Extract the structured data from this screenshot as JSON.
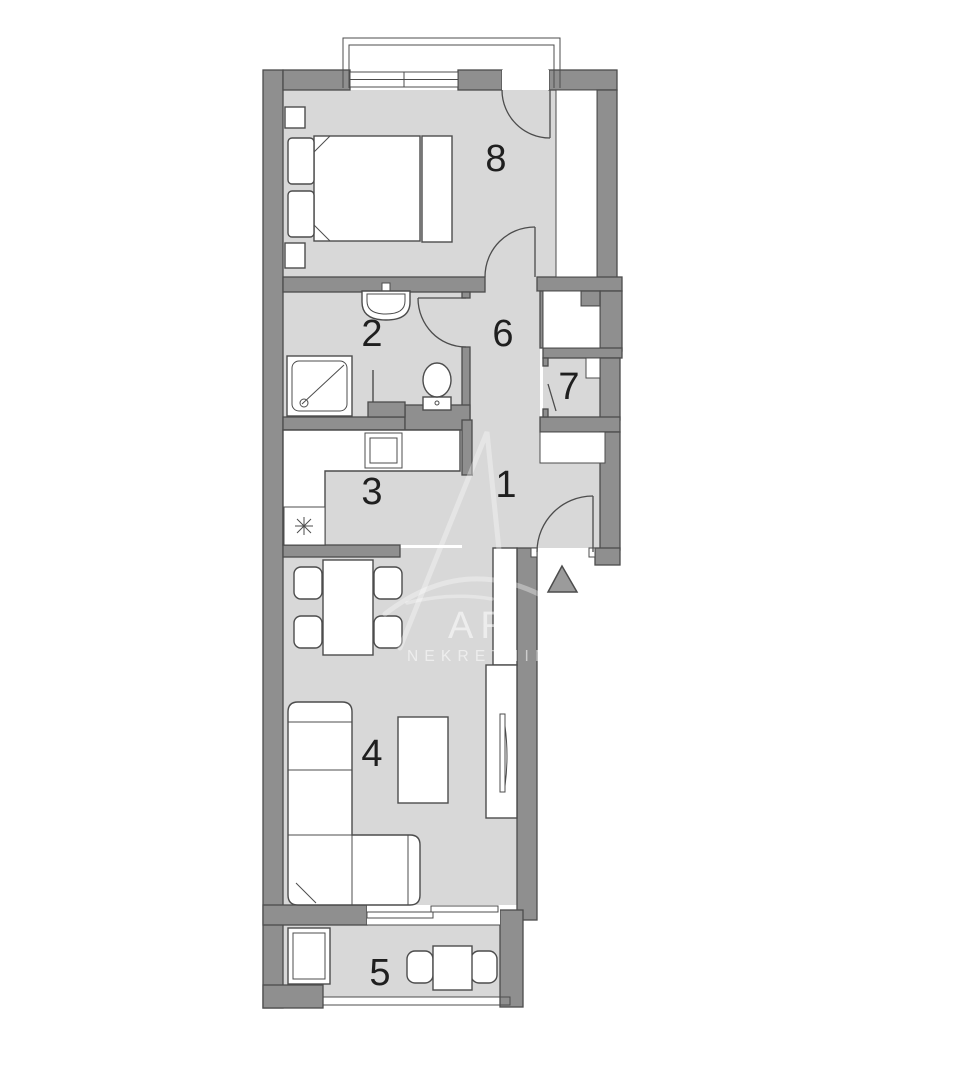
{
  "colors": {
    "wall": "#8f8f8f",
    "wall_outline": "#4c4c4c",
    "floor": "#d8d8d8",
    "furniture": "#ffffff",
    "furniture_line": "#4c4c4c",
    "label": "#1f1f1f",
    "watermark": "#ffffff",
    "entrance": "#9b9b9b",
    "background": "#ffffff"
  },
  "room_labels": [
    "1",
    "2",
    "3",
    "4",
    "5",
    "6",
    "7",
    "8"
  ],
  "watermark": {
    "brand_text": "AR",
    "tagline_text": "NEKRETNINE"
  }
}
